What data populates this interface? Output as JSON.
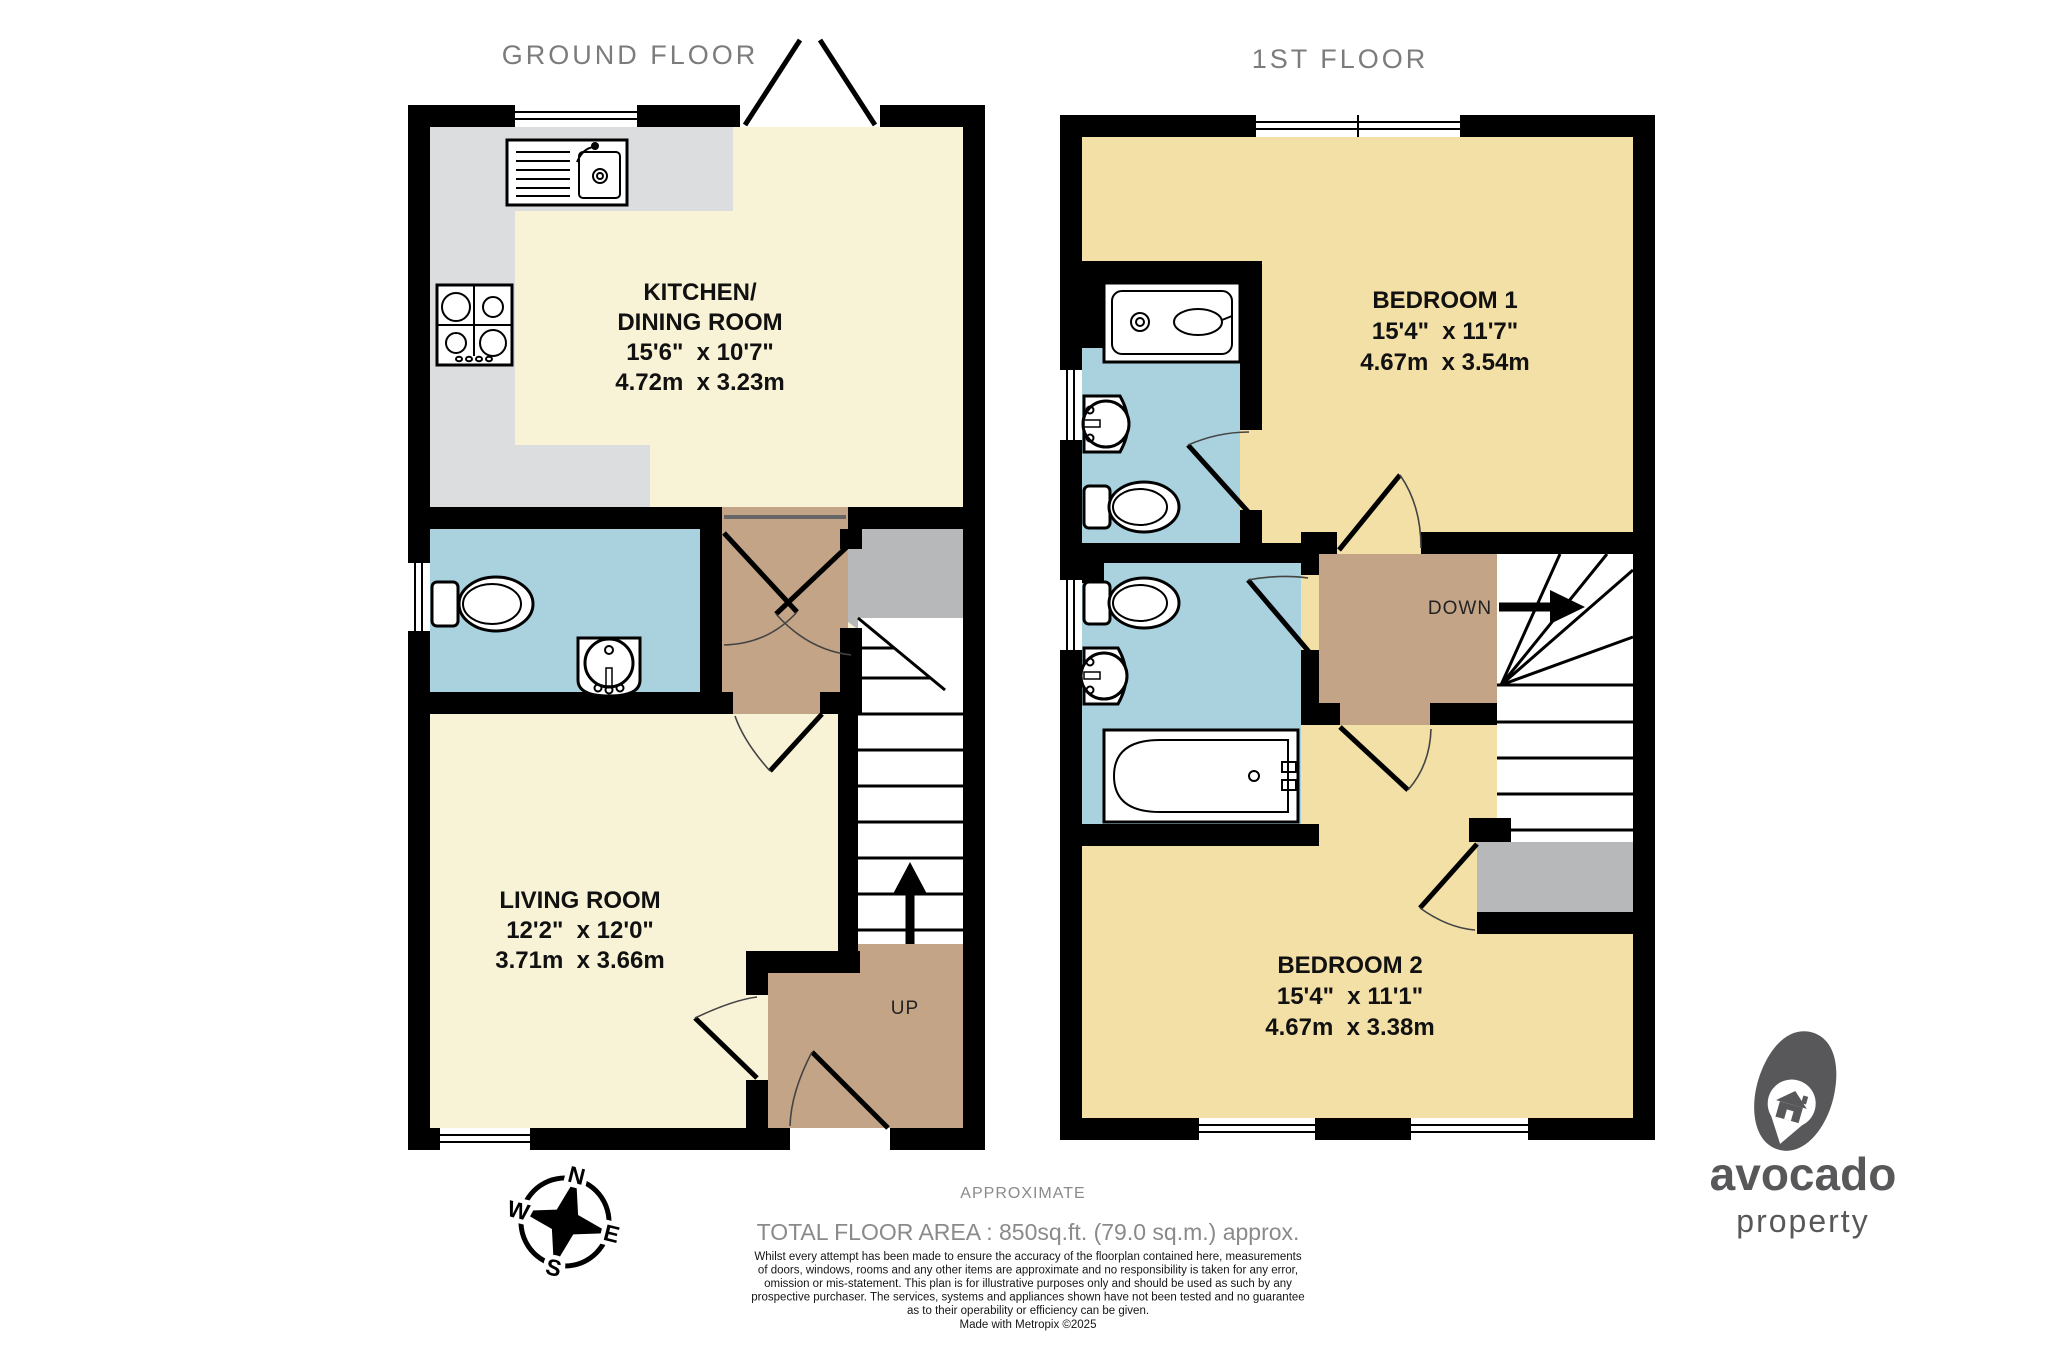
{
  "titles": {
    "ground": "GROUND FLOOR",
    "first": "1ST FLOOR"
  },
  "rooms": {
    "kitchen": {
      "name1": "KITCHEN/",
      "name2": "DINING ROOM",
      "imperial": "15'6\"  x 10'7\"",
      "metric": "4.72m  x 3.23m"
    },
    "living": {
      "name1": "LIVING ROOM",
      "imperial": "12'2\"  x 12'0\"",
      "metric": "3.71m  x 3.66m"
    },
    "bedroom1": {
      "name1": "BEDROOM 1",
      "imperial": "15'4\"  x 11'7\"",
      "metric": "4.67m  x 3.54m"
    },
    "bedroom2": {
      "name1": "BEDROOM 2",
      "imperial": "15'4\"  x 11'1\"",
      "metric": "4.67m  x 3.38m"
    }
  },
  "stairs": {
    "up": "UP",
    "down": "DOWN"
  },
  "compass": {
    "n": "N",
    "e": "E",
    "s": "S",
    "w": "W"
  },
  "footer": {
    "approximate": "APPROXIMATE",
    "total_area": "TOTAL FLOOR AREA : 850sq.ft. (79.0 sq.m.) approx.",
    "disclaimer": [
      "Whilst every attempt has been made to ensure the accuracy of the floorplan contained here, measurements",
      "of doors, windows, rooms and any other items are approximate and no responsibility is taken for any error,",
      "omission or mis-statement. This plan is for illustrative purposes only and should be used as such by any",
      "prospective purchaser. The services, systems and appliances shown have not been tested and no guarantee",
      "as to their operability or efficiency can be given."
    ],
    "made_with": "Made with Metropix ©2025"
  },
  "logo": {
    "line1": "avocado",
    "line2": "property"
  },
  "colors": {
    "wall": "#000000",
    "creamGround": "#f8f3d6",
    "creamBed": "#f3e0a6",
    "blue": "#a9d2de",
    "tan": "#c4a487",
    "counter": "#dcdddf",
    "cupboardGray": "#b7b8ba",
    "titleGray": "#7c7c7c",
    "footGray": "#8a8a8a",
    "logoGray": "#58585a",
    "threshold": "#666666"
  }
}
